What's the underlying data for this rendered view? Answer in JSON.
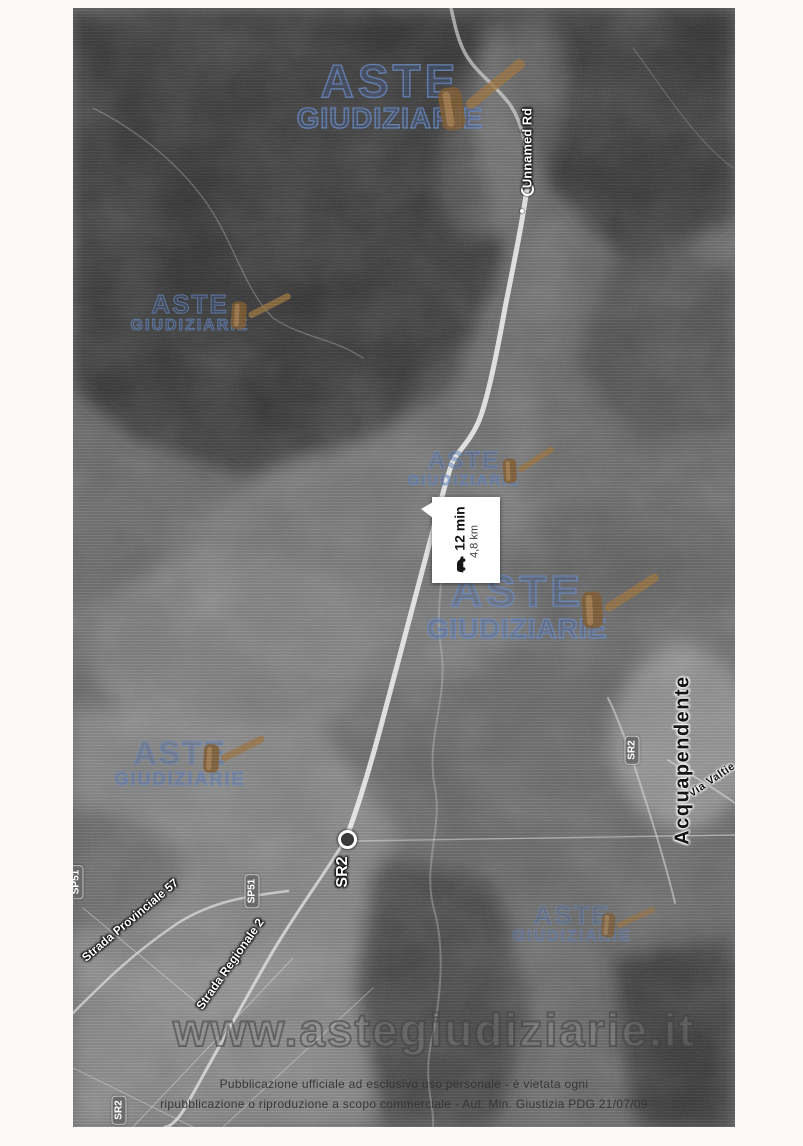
{
  "watermark": {
    "line1": "ASTE",
    "line2": "GIUDIZIARIE",
    "site": "www.astegiudiziarie.it",
    "color": "#4a6da7",
    "icon": "gavel-icon"
  },
  "route": {
    "duration": "12 min",
    "distance": "4,8 km",
    "mode": "drive",
    "mode_icon": "car-icon",
    "origin_label": "SR2",
    "destination_label": "Unnamed Rd"
  },
  "map": {
    "type": "satellite",
    "labels": {
      "unnamed_rd": "Unnamed Rd",
      "sr2_origin": "SR2",
      "sp51_left": "SP51",
      "sp51_mid": "SP51",
      "strada_provinciale": "Strada Provinciale 57",
      "strada_regionale": "Strada Regionale 2",
      "sr2_shield": "SR2",
      "via_valtie": "Via Valtie",
      "acquapendente": "Acquapendente",
      "sr2_bottom": "SR2"
    }
  },
  "footer": {
    "line1": "Pubblicazione ufficiale ad esclusivo uso personale - è vietata ogni",
    "line2": "ripubblicazione o riproduzione a scopo commerciale - Aut. Min. Giustizia PDG 21/07/09"
  }
}
